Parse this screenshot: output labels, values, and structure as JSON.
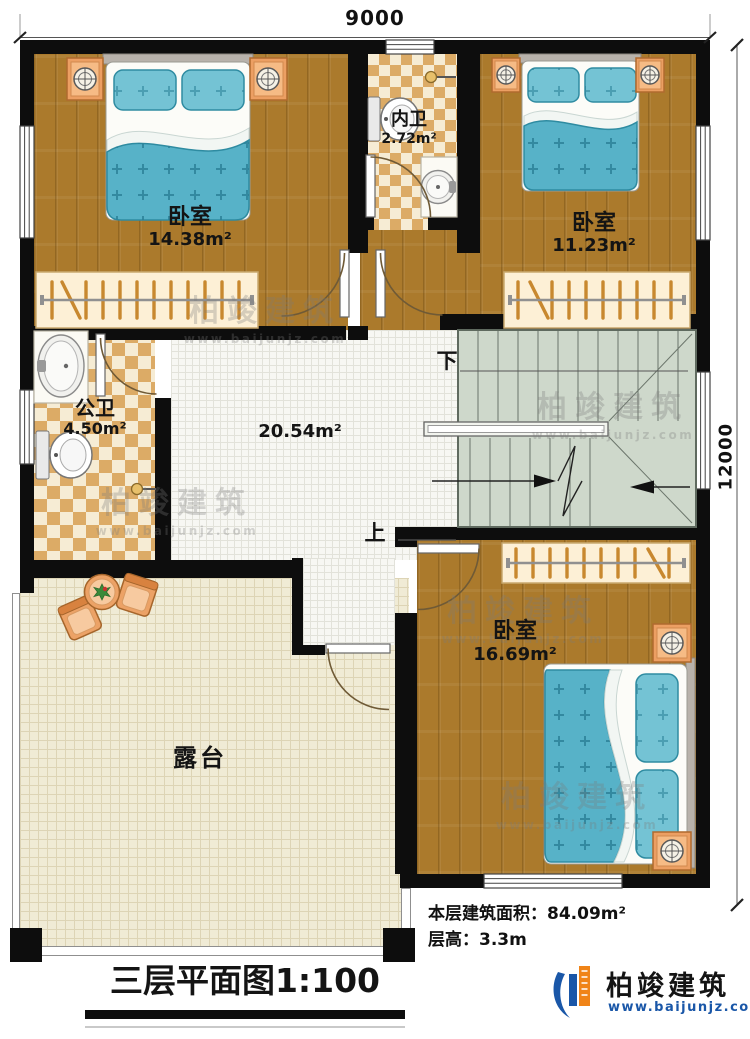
{
  "dimensions": {
    "width": "9000",
    "height": "12000"
  },
  "rooms": {
    "bedroom1": {
      "label": "卧室",
      "area": "14.38m²"
    },
    "inner_bath": {
      "label": "内卫",
      "area": "2.72m²"
    },
    "bedroom2": {
      "label": "卧室",
      "area": "11.23m²"
    },
    "public_bath": {
      "label": "公卫",
      "area": "4.50m²"
    },
    "hall": {
      "area": "20.54m²"
    },
    "bedroom3": {
      "label": "卧室",
      "area": "16.69m²"
    },
    "terrace": {
      "label": "露台"
    }
  },
  "stairs": {
    "down_label": "下",
    "up_label": "上"
  },
  "notes": {
    "floor_area": "本层建筑面积：84.09m²",
    "floor_height": "层高：3.3m"
  },
  "title": "三层平面图1:100",
  "brand": {
    "name": "柏竣建筑",
    "url": "www.baijunjz.com"
  }
}
